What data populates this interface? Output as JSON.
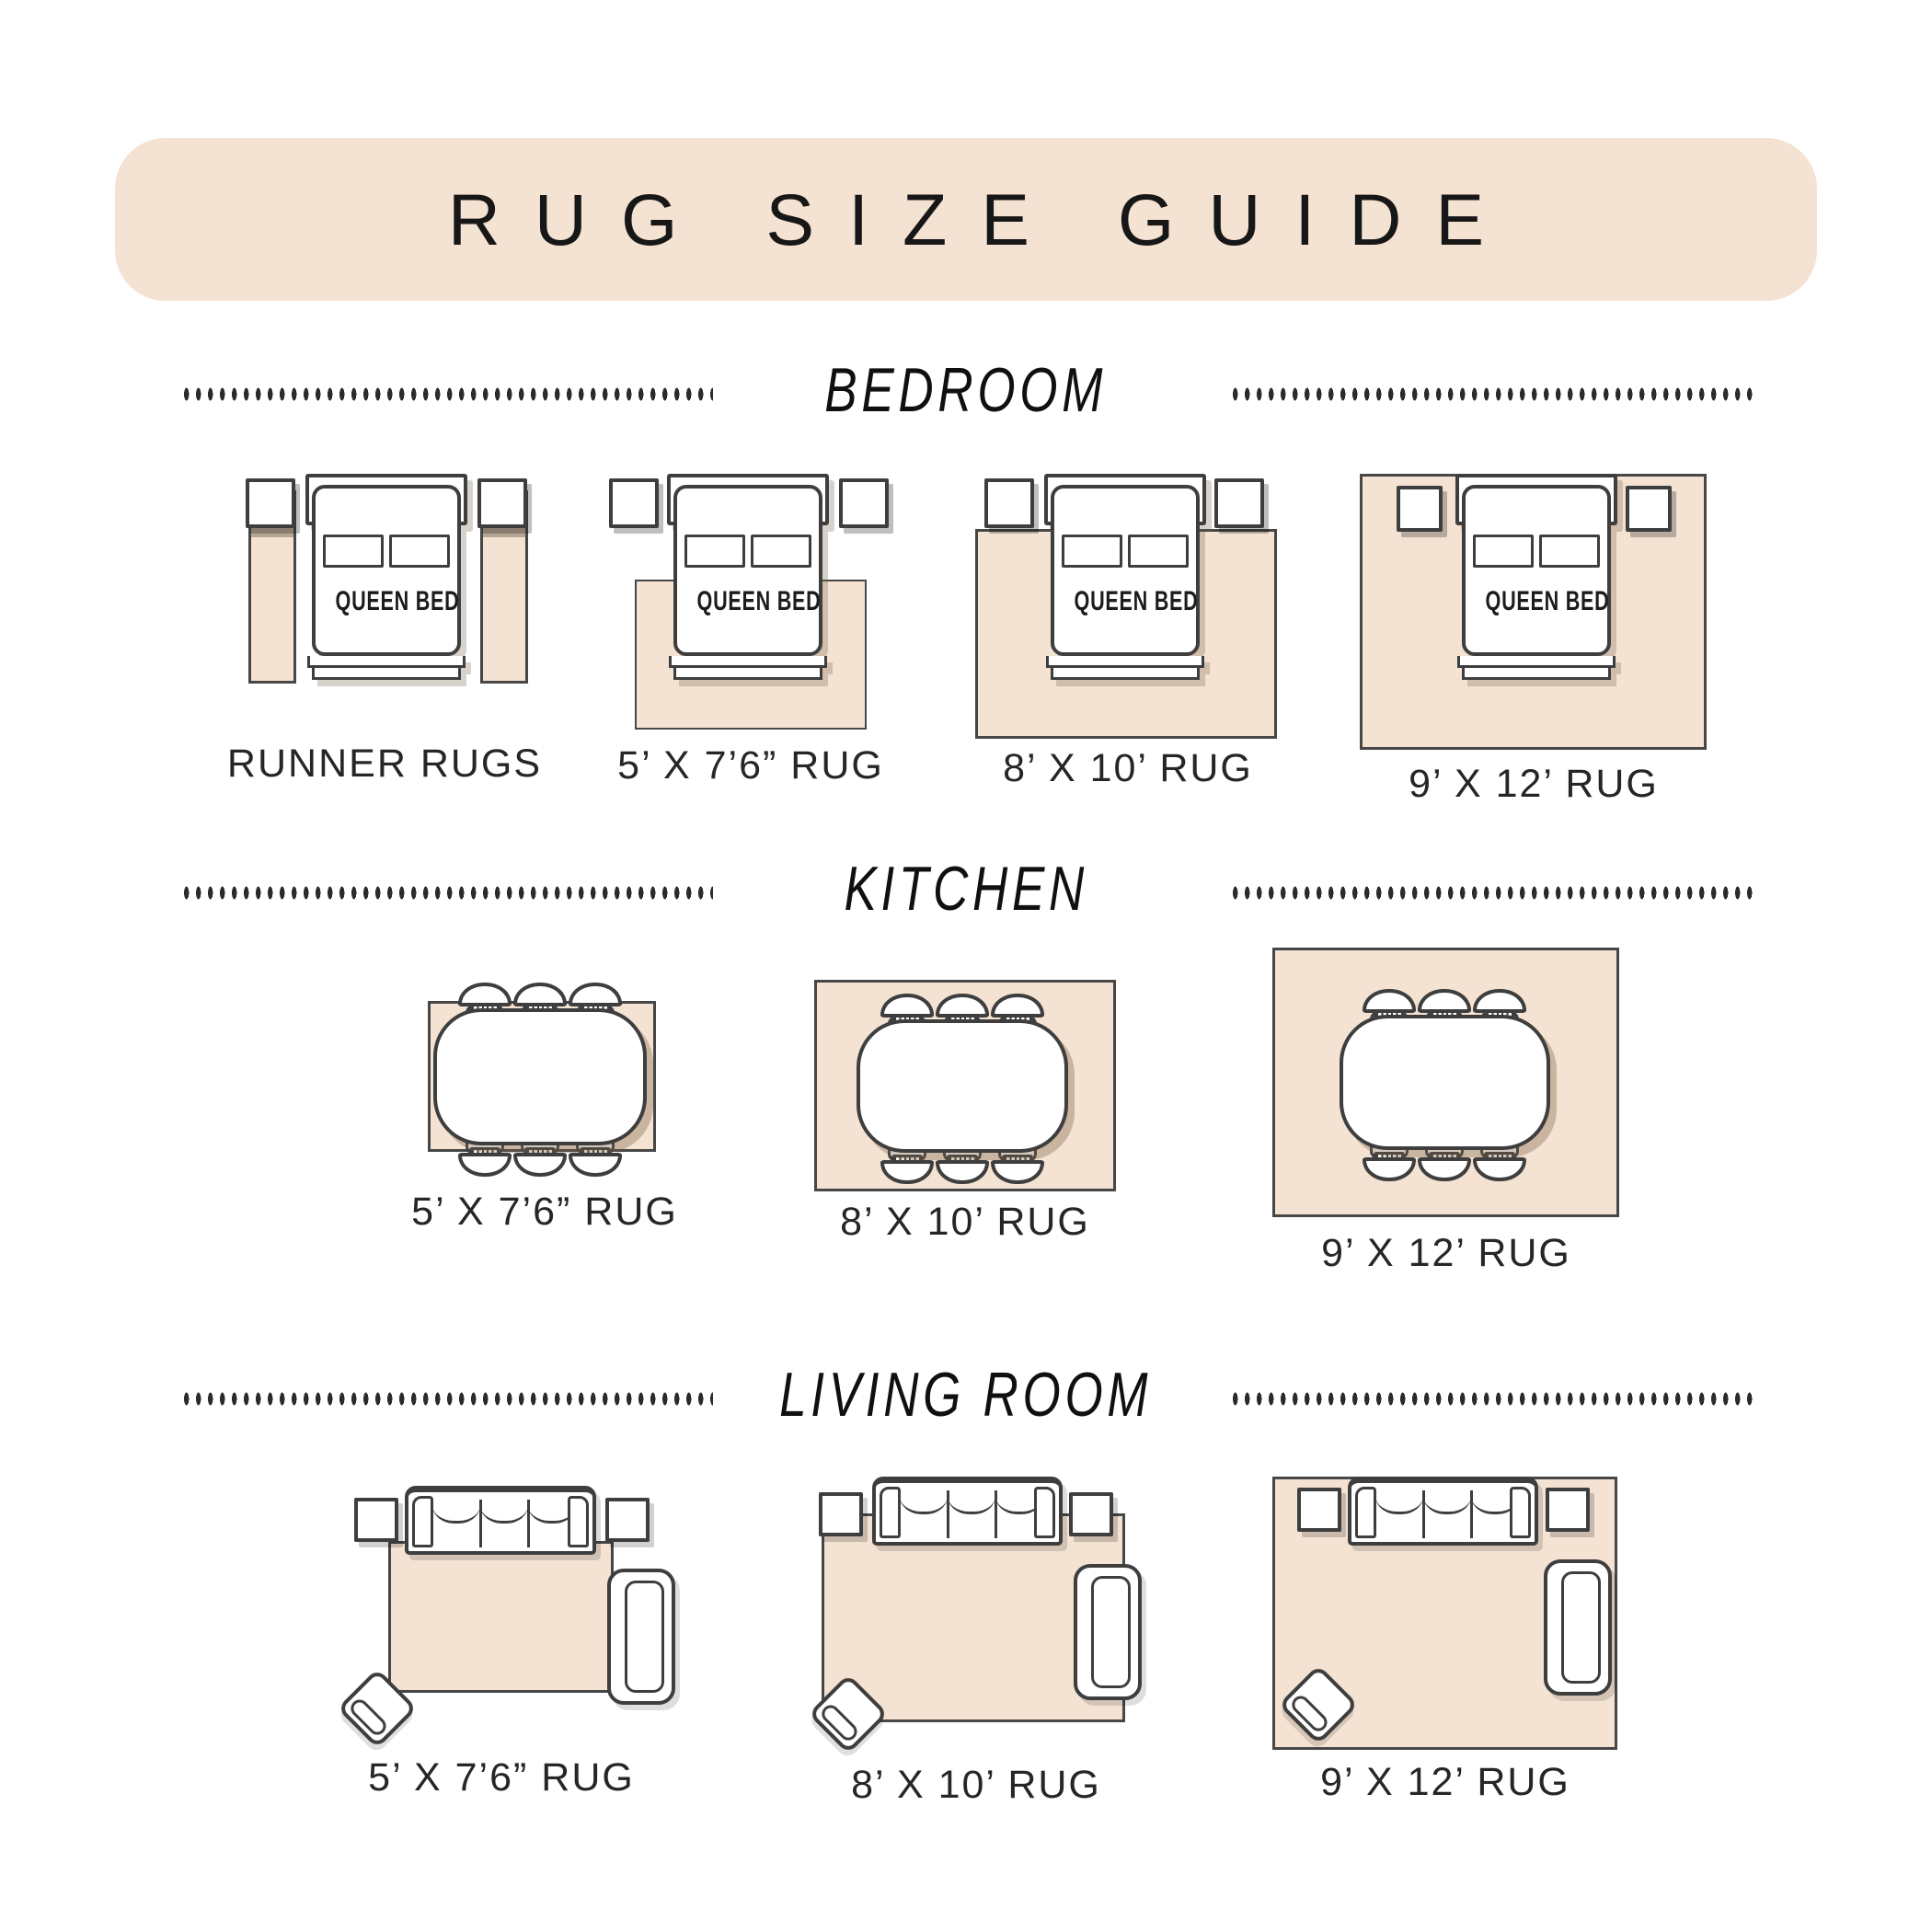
{
  "title": "RUG SIZE GUIDE",
  "colors": {
    "banner": "#f4e2d2",
    "rug": "#f4e2d2",
    "outline": "#3e3e3e",
    "text": "#262626"
  },
  "sections": [
    {
      "name": "BEDROOM",
      "items": [
        {
          "label": "RUNNER RUGS",
          "furniture_label": "QUEEN BED"
        },
        {
          "label": "5’ X 7’6” RUG",
          "furniture_label": "QUEEN BED"
        },
        {
          "label": "8’ X 10’ RUG",
          "furniture_label": "QUEEN BED"
        },
        {
          "label": "9’ X 12’ RUG",
          "furniture_label": "QUEEN BED"
        }
      ]
    },
    {
      "name": "KITCHEN",
      "items": [
        {
          "label": "5’ X 7’6” RUG"
        },
        {
          "label": "8’ X 10’ RUG"
        },
        {
          "label": "9’ X 12’ RUG"
        }
      ]
    },
    {
      "name": "LIVING ROOM",
      "items": [
        {
          "label": "5’ X 7’6” RUG"
        },
        {
          "label": "8’ X 10’ RUG"
        },
        {
          "label": "9’ X 12’ RUG"
        }
      ]
    }
  ]
}
